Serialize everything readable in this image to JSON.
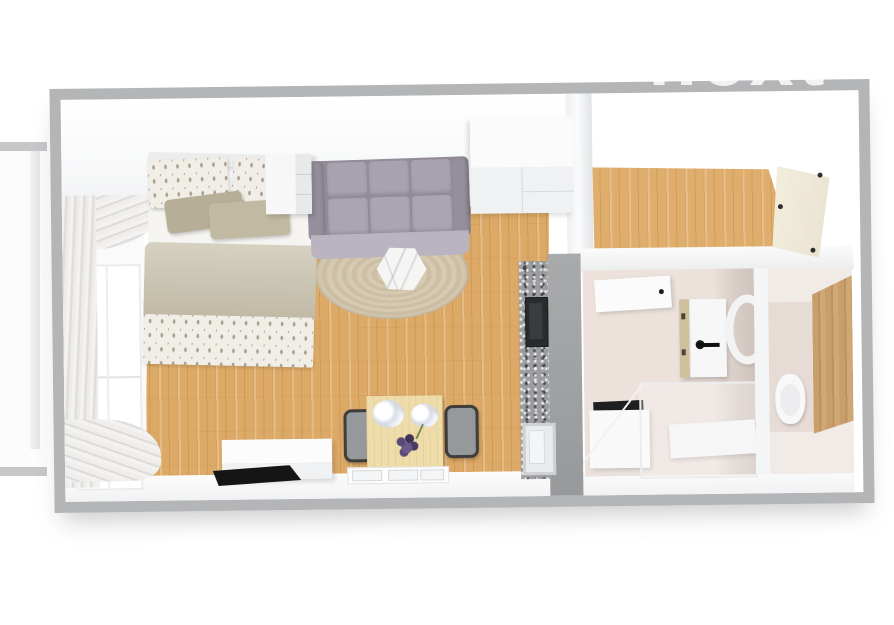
{
  "watermark": {
    "text": "next"
  },
  "palette": {
    "background": "#ffffff",
    "wall_outer": "#b4b5b7",
    "wall_inner_face": "#f4f5f6",
    "partition_wall": "#9fa1a3",
    "wood_floor": "#dcaa66",
    "hallway_floor": "#dfae6c",
    "bathroom_floor": "#ece1db",
    "bathroom_wall_shadow": "#d0c3bd",
    "wc_floor": "#e7dbd6",
    "wc_wood_panel": "#c89f6c",
    "sofa": "#a8a2ae",
    "sofa_front": "#bab4c0",
    "rug": "#d3c6af",
    "coffee_table_marble": "#f5f5f3",
    "bed_duvet": "#c8c1ac",
    "bed_accent_pillow": "#bcb39c",
    "bed_textile_pattern_base": "#f1eee8",
    "kitchen_counter_granite": "#9b9da0",
    "cooktop": "#292b2d",
    "dining_table_wood": "#eeddab",
    "bouquet_purple": "#584a78",
    "chair_frame": "#3f3e3c",
    "laptop": "#151515",
    "entry_door": "#f2ecdc",
    "boiler_side": "#cfc09c"
  },
  "scene": {
    "type": "3d-floor-plan-top-view",
    "rooms": [
      {
        "name": "living-bedroom",
        "items": [
          "window",
          "curtains",
          "double-bed",
          "patterned-pillows",
          "accent-cushions",
          "duvet",
          "nightstand",
          "sofa",
          "round-rug",
          "hexagon-coffee-table",
          "wardrobe",
          "kitchenette-counter",
          "cooktop",
          "sink",
          "sideboard-desk",
          "laptop",
          "dining-table",
          "flower-bouquet",
          "chair-left",
          "chair-right",
          "table-runner"
        ]
      },
      {
        "name": "hallway",
        "items": [
          "entry-door"
        ]
      },
      {
        "name": "bathroom",
        "items": [
          "open-door-panel",
          "wall-boiler-cabinet",
          "towel-ring",
          "washer-cabinet",
          "shower-enclosure"
        ]
      },
      {
        "name": "wc",
        "items": [
          "toilet",
          "wood-panel-door"
        ]
      }
    ],
    "exterior": [
      "balcony-slab"
    ]
  }
}
